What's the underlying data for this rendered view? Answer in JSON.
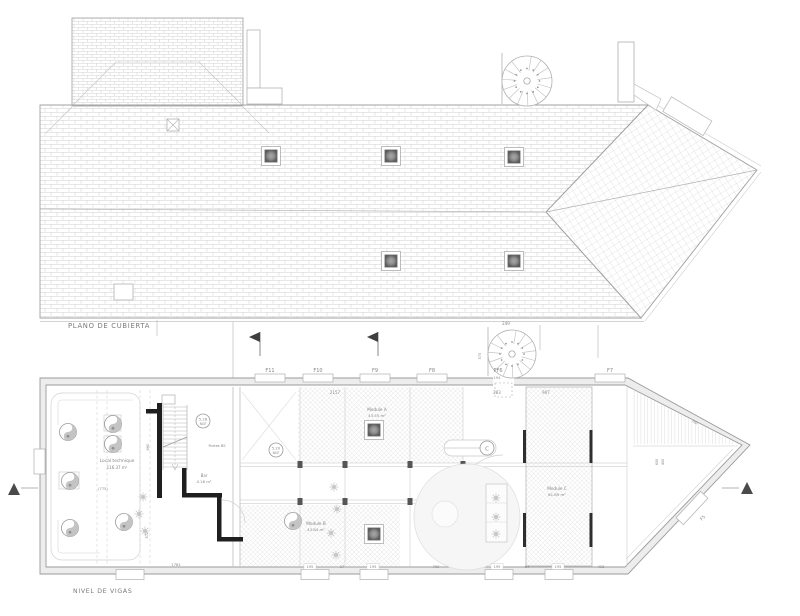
{
  "colors": {
    "line": "#c2c2c2",
    "line_dark": "#9a9a9a",
    "wall_fill": "#ededed",
    "black": "#1f1f1f",
    "text": "#868686",
    "skylight_dark": "#5a5a5a"
  },
  "roof_plan": {
    "label": "PLANO DE CUBIERTA",
    "skylights": [
      {
        "x": 271,
        "y": 156
      },
      {
        "x": 391,
        "y": 156
      },
      {
        "x": 514,
        "y": 157
      },
      {
        "x": 391,
        "y": 261
      },
      {
        "x": 514,
        "y": 261
      }
    ]
  },
  "floor_plan": {
    "label": "NIVEL DE VIGAS",
    "ref_c": "C",
    "f5_label": "F5",
    "window_labels": [
      {
        "t": "F11",
        "x": 270,
        "box": true
      },
      {
        "t": "F10",
        "x": 318,
        "box": true
      },
      {
        "t": "F9",
        "x": 375,
        "box": true
      },
      {
        "t": "F8",
        "x": 432,
        "box": true
      },
      {
        "t": "PF6",
        "x": 498,
        "box": false
      },
      {
        "t": "F7",
        "x": 610,
        "box": true
      }
    ],
    "bottom_windows": [
      130,
      315,
      374,
      499,
      559
    ],
    "flags": [
      260,
      378
    ],
    "rooms": [
      {
        "t": "Local technique",
        "x": 117,
        "y": 462,
        "s": 4.4
      },
      {
        "t": "116.37 m²",
        "x": 117,
        "y": 469,
        "s": 4
      },
      {
        "t": "Bar",
        "x": 204,
        "y": 477,
        "s": 4
      },
      {
        "t": "4.16 m²",
        "x": 204,
        "y": 483,
        "s": 3.8
      },
      {
        "t": "Portes BS",
        "x": 217,
        "y": 447,
        "s": 3.6
      },
      {
        "t": "Module A",
        "x": 377,
        "y": 411,
        "s": 4.2
      },
      {
        "t": "43.55 m²",
        "x": 377,
        "y": 417,
        "s": 3.9
      },
      {
        "t": "Module B",
        "x": 316,
        "y": 525,
        "s": 4.2
      },
      {
        "t": "43.84 m²",
        "x": 316,
        "y": 531,
        "s": 3.9
      },
      {
        "t": "Module C",
        "x": 557,
        "y": 490,
        "s": 4.2
      },
      {
        "t": "61.89 m²",
        "x": 557,
        "y": 496,
        "s": 3.9
      }
    ],
    "levels": [
      {
        "v": "5.28",
        "d": "NGF",
        "x": 203,
        "y": 421
      },
      {
        "v": "5.20",
        "d": "NGF",
        "x": 276,
        "y": 450
      }
    ],
    "dimensions": [
      {
        "t": "2157",
        "x": 335,
        "y": 394
      },
      {
        "t": "283",
        "x": 497,
        "y": 394
      },
      {
        "t": "907",
        "x": 546,
        "y": 394
      },
      {
        "t": "249",
        "x": 506,
        "y": 325
      },
      {
        "t": "194",
        "x": 497,
        "y": 379,
        "s": 3.5
      },
      {
        "t": "575",
        "x": 481,
        "y": 356,
        "r": -90,
        "s": 3.5
      },
      {
        "t": "660",
        "x": 149,
        "y": 447,
        "r": -90,
        "s": 3.6
      },
      {
        "t": "572",
        "x": 148,
        "y": 535,
        "r": -90,
        "s": 3.6
      },
      {
        "t": "(775)",
        "x": 103,
        "y": 490,
        "s": 3.6
      },
      {
        "t": "1781",
        "x": 176,
        "y": 566,
        "s": 3.8
      },
      {
        "t": "195",
        "x": 310,
        "y": 568,
        "box": true,
        "s": 3.6
      },
      {
        "t": "27",
        "x": 342,
        "y": 568,
        "s": 3.6
      },
      {
        "t": "195",
        "x": 373,
        "y": 568,
        "box": true,
        "s": 3.6
      },
      {
        "t": "700",
        "x": 436,
        "y": 568,
        "s": 3.6
      },
      {
        "t": "195",
        "x": 497,
        "y": 568,
        "box": true,
        "s": 3.6
      },
      {
        "t": "84",
        "x": 527,
        "y": 568,
        "s": 3.6
      },
      {
        "t": "195",
        "x": 558,
        "y": 568,
        "box": true,
        "s": 3.6
      },
      {
        "t": "428",
        "x": 601,
        "y": 568,
        "s": 3.6
      },
      {
        "t": "760",
        "x": 694,
        "y": 423,
        "r": 29,
        "s": 3.6
      },
      {
        "t": "600",
        "x": 658,
        "y": 462,
        "r": -90,
        "s": 3.3
      },
      {
        "t": "400",
        "x": 664,
        "y": 462,
        "r": -90,
        "s": 3.3
      }
    ],
    "fans": [
      {
        "x": 68,
        "y": 432
      },
      {
        "x": 113,
        "y": 424
      },
      {
        "x": 113,
        "y": 444
      },
      {
        "x": 70,
        "y": 481
      },
      {
        "x": 70,
        "y": 528
      },
      {
        "x": 124,
        "y": 522
      },
      {
        "x": 293,
        "y": 521
      }
    ],
    "flowers": [
      {
        "x": 143,
        "y": 497
      },
      {
        "x": 139,
        "y": 514
      },
      {
        "x": 145,
        "y": 531
      },
      {
        "x": 334,
        "y": 487
      },
      {
        "x": 337,
        "y": 509
      },
      {
        "x": 331,
        "y": 533
      },
      {
        "x": 336,
        "y": 555
      },
      {
        "x": 496,
        "y": 498
      },
      {
        "x": 496,
        "y": 517
      },
      {
        "x": 496,
        "y": 534
      }
    ],
    "skylights": [
      {
        "x": 374,
        "y": 430
      },
      {
        "x": 374,
        "y": 534
      }
    ]
  }
}
